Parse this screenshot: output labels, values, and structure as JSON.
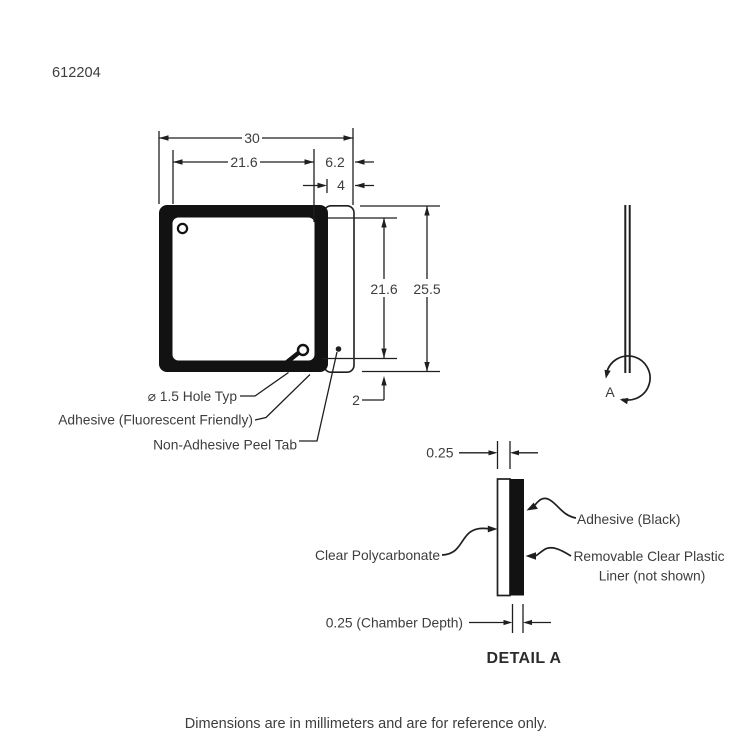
{
  "drawing": {
    "part_number": "612204",
    "footer_note": "Dimensions are in millimeters and are for reference only.",
    "front_view": {
      "dim_outer_width": "30",
      "dim_inner_width": "21.6",
      "dim_tab_overall": "6.2",
      "dim_tab_width": "4",
      "dim_inner_height": "21.6",
      "dim_outer_height": "25.5",
      "dim_border_thickness": "2",
      "hole_callout": "⌀ 1.5 Hole Typ",
      "adhesive_callout": "Adhesive (Fluorescent Friendly)",
      "peel_tab_callout": "Non-Adhesive Peel Tab"
    },
    "side_view": {
      "detail_marker": "A"
    },
    "detail_view": {
      "title": "DETAIL A",
      "dim_polycarbonate_thickness": "0.25",
      "dim_chamber_depth": "0.25 (Chamber Depth)",
      "adhesive_callout": "Adhesive (Black)",
      "polycarbonate_callout": "Clear Polycarbonate",
      "liner_callout_line1": "Removable Clear Plastic",
      "liner_callout_line2": "Liner (not shown)"
    },
    "colors": {
      "line": "#1f1f1f",
      "fill": "#121212",
      "text": "#3d3d3d",
      "background": "#ffffff"
    }
  }
}
